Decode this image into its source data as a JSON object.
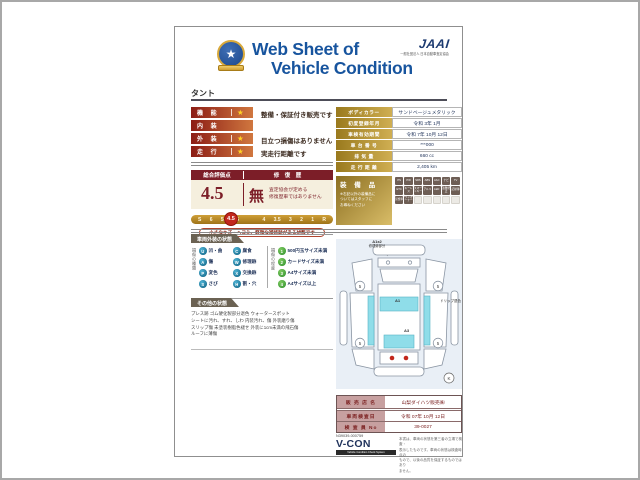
{
  "header": {
    "title_line1": "Web Sheet of",
    "title_line2": "Vehicle Condition",
    "jaai_logo": "JAAI",
    "jaai_subtitle": "一般社団法人 日本自動車査定協会",
    "model_name": "タント"
  },
  "ratings": {
    "rows": [
      {
        "label": "機 能",
        "star": "★",
        "text": "整備・保証付き販売です"
      },
      {
        "label": "内 装",
        "star": "",
        "text": ""
      },
      {
        "label": "外 装",
        "star": "★",
        "text": "目立つ損傷はありません"
      },
      {
        "label": "走 行",
        "star": "★",
        "text": "実走行距離です"
      }
    ]
  },
  "evaluation": {
    "score_header": "総合評価点",
    "history_header": "修 復 歴",
    "score": "4.5",
    "history_value": "無",
    "history_note_line1": "査定協会が定める",
    "history_note_line2": "修復歴車ではありません",
    "scale": [
      "S",
      "6",
      "5.5",
      "5",
      "4.5",
      "4",
      "3.5",
      "3",
      "2",
      "1",
      "R"
    ],
    "selected": "4.5",
    "caption": "小さなキズ・ヘコミ、軽微な補修跡がある状態です"
  },
  "vehicle_info": {
    "rows": [
      {
        "label": "ボディカラー",
        "value": "サンドベージュメタリック"
      },
      {
        "label": "初度登録年月",
        "value": "令和 3年 1月"
      },
      {
        "label": "車検有効期間",
        "value": "令和 7年 10月 12日"
      },
      {
        "label": "車 台 番 号",
        "value": "***000"
      },
      {
        "label": "排  気  量",
        "value": "660 cc"
      },
      {
        "label": "走 行 距 離",
        "value": "2,405 km"
      }
    ]
  },
  "equipment": {
    "title": "装 備 品",
    "note_line1": "※右記以外の装備品に",
    "note_line2": "ついてはスタッフに",
    "note_line3": "お尋ねください",
    "badges": [
      "PS",
      "PW",
      "SRS",
      "ABS",
      "AAC",
      "ナビ",
      "TV",
      "ETC",
      "キーレス",
      "スマートキー",
      "アルミ",
      "LED",
      "盗難防止",
      "記録簿",
      "禁煙車",
      "ワンオーナー"
    ]
  },
  "exterior": {
    "section_title": "車両外装の状態",
    "type_title": "損傷の種類",
    "types": [
      {
        "code": "U",
        "label": "凹・曲"
      },
      {
        "code": "C",
        "label": "腐食"
      },
      {
        "code": "A",
        "label": "傷"
      },
      {
        "code": "W",
        "label": "修理跡"
      },
      {
        "code": "P",
        "label": "変色"
      },
      {
        "code": "X",
        "label": "交換跡"
      },
      {
        "code": "S",
        "label": "さび"
      },
      {
        "code": "H",
        "label": "割・穴"
      }
    ],
    "extent_title": "損傷の程度",
    "extents": [
      {
        "code": "1",
        "label": "500円玉サイズ未満"
      },
      {
        "code": "2",
        "label": "カードサイズ未満"
      },
      {
        "code": "3",
        "label": "A4サイズ未満"
      },
      {
        "code": "4",
        "label": "A4サイズ以上"
      }
    ]
  },
  "other": {
    "section_title": "その他の状態",
    "lines": [
      "プレス跡 ゴム硬化製部分退色 ウォータースポット",
      "シートに汚れ、すれ、しわ 内装汚れ、傷 外装磨り傷",
      "スリップ傷 未塗装樹脂色褪せ 外装に1cm未満の飛石傷",
      "ルーフに薄傷"
    ]
  },
  "diagram": {
    "front_note_line1": "A1x2",
    "front_note_line2": "修理跡部分",
    "side_note": "ドリップ退色",
    "roof_mark": "A1",
    "rear_mark": "A3",
    "wheel_mark": "5",
    "corner_mark": "K"
  },
  "dealer": {
    "rows": [
      {
        "label": "販 売 店 名",
        "value": "山梨ダイハツ販売㈱"
      },
      {
        "label": "車両検査日",
        "value": "令和 07年 10月 12日"
      },
      {
        "label": "検 査 員 No",
        "value": "39-0027"
      }
    ],
    "code": "N39039-000759",
    "vcon_logo": "V-CON",
    "vcon_sub": "Vehicle Condition Check System",
    "disclaimer_line1": "本書は、車両の状態を第三者の立場で検査・",
    "disclaimer_line2": "表示したものです。車両の状態は検査時点の",
    "disclaimer_line3": "もので、以後の品質を保証するものではあり",
    "disclaimer_line4": "ません。"
  },
  "colors": {
    "accent_blue": "#17549e",
    "maroon": "#7c1e28",
    "gold": "#b8912f",
    "cyan_panel": "#8fdde9",
    "damage_red": "#c2271c"
  }
}
